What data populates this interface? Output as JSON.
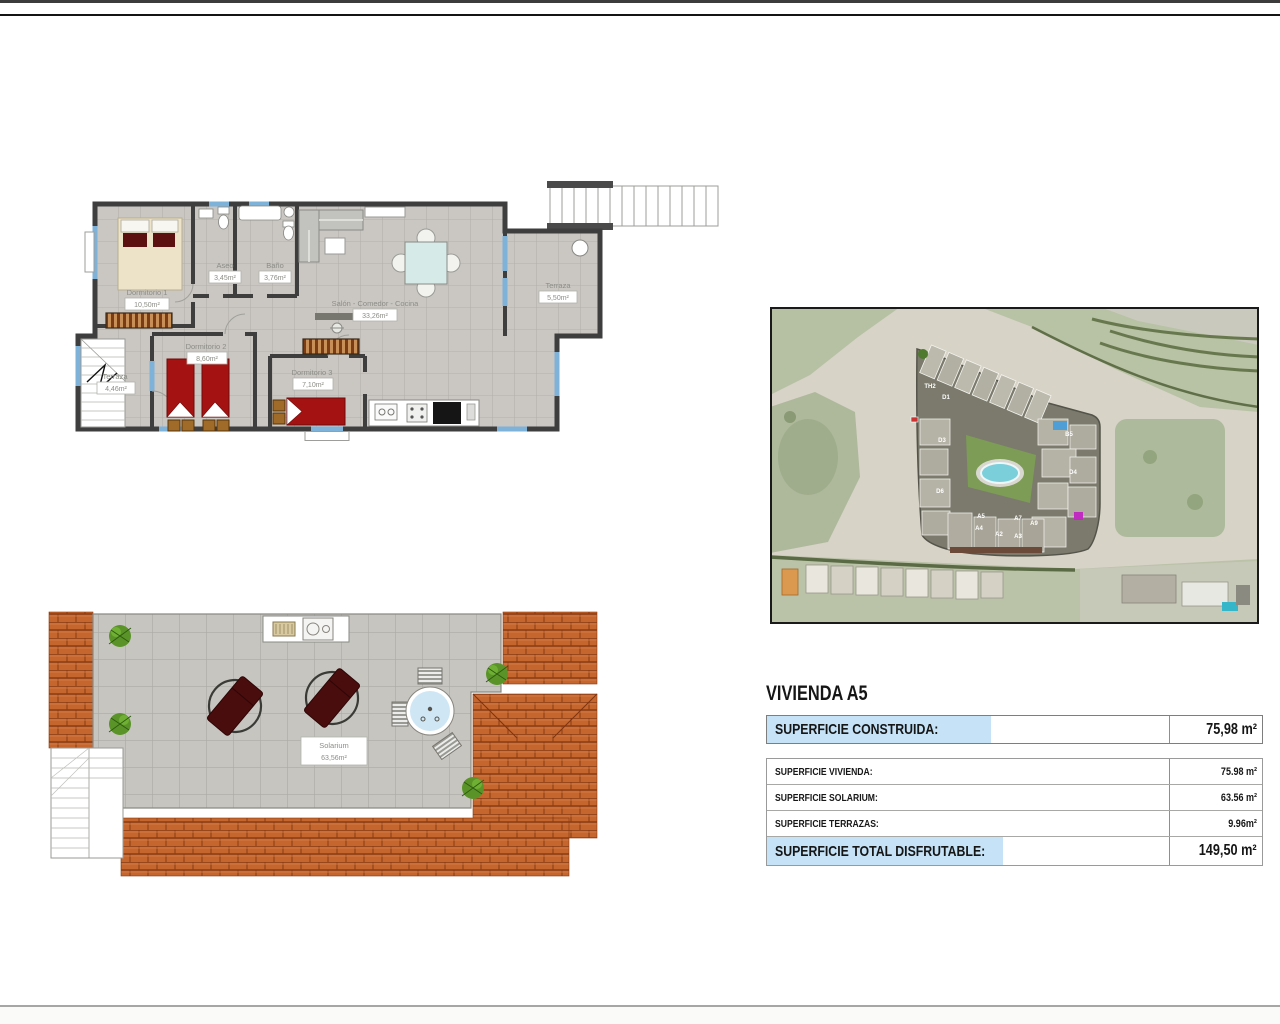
{
  "floorplan": {
    "rooms": {
      "dorm1": {
        "name": "Dormitorio 1",
        "area": "10,50m²"
      },
      "aseo": {
        "name": "Aseo",
        "area": "3,45m²"
      },
      "bano": {
        "name": "Baño",
        "area": "3,76m²"
      },
      "salon": {
        "name": "Salón - Comedor - Cocina",
        "area": "33,26m²"
      },
      "terraza_salon": {
        "name": "Terraza",
        "area": "5,50m²"
      },
      "dorm2": {
        "name": "Dormitorio 2",
        "area": "8,60m²"
      },
      "dorm3": {
        "name": "Dormitorio 3",
        "area": "7,10m²"
      },
      "terraza_dorm": {
        "name": "Terraza",
        "area": "4,46m²"
      }
    }
  },
  "solarium": {
    "name": "Solarium",
    "area": "63,56m²"
  },
  "map": {
    "building_labels": [
      "TH2",
      "D1",
      "D3",
      "D6",
      "B5",
      "D4",
      "A7",
      "A9",
      "A5",
      "A4",
      "A2",
      "A3"
    ]
  },
  "panel": {
    "title": "VIVIENDA A5",
    "construida": {
      "label": "SUPERFICIE CONSTRUIDA:",
      "value": "75,98 m²"
    },
    "rows": [
      {
        "label": "SUPERFICIE VIVIENDA:",
        "value": "75.98 m²"
      },
      {
        "label": "SUPERFICIE SOLARIUM:",
        "value": "63.56 m²"
      },
      {
        "label": "SUPERFICIE TERRAZAS:",
        "value": "9.96m²"
      }
    ],
    "total": {
      "label": "SUPERFICIE TOTAL DISFRUTABLE:",
      "value": "149,50 m²"
    }
  },
  "colors": {
    "highlight_blue": "#c5e2f7",
    "terracotta": "#c4662e",
    "pool_teal": "#7bcfda",
    "bed_red": "#a51212",
    "window_blue": "#7fb2d9"
  }
}
